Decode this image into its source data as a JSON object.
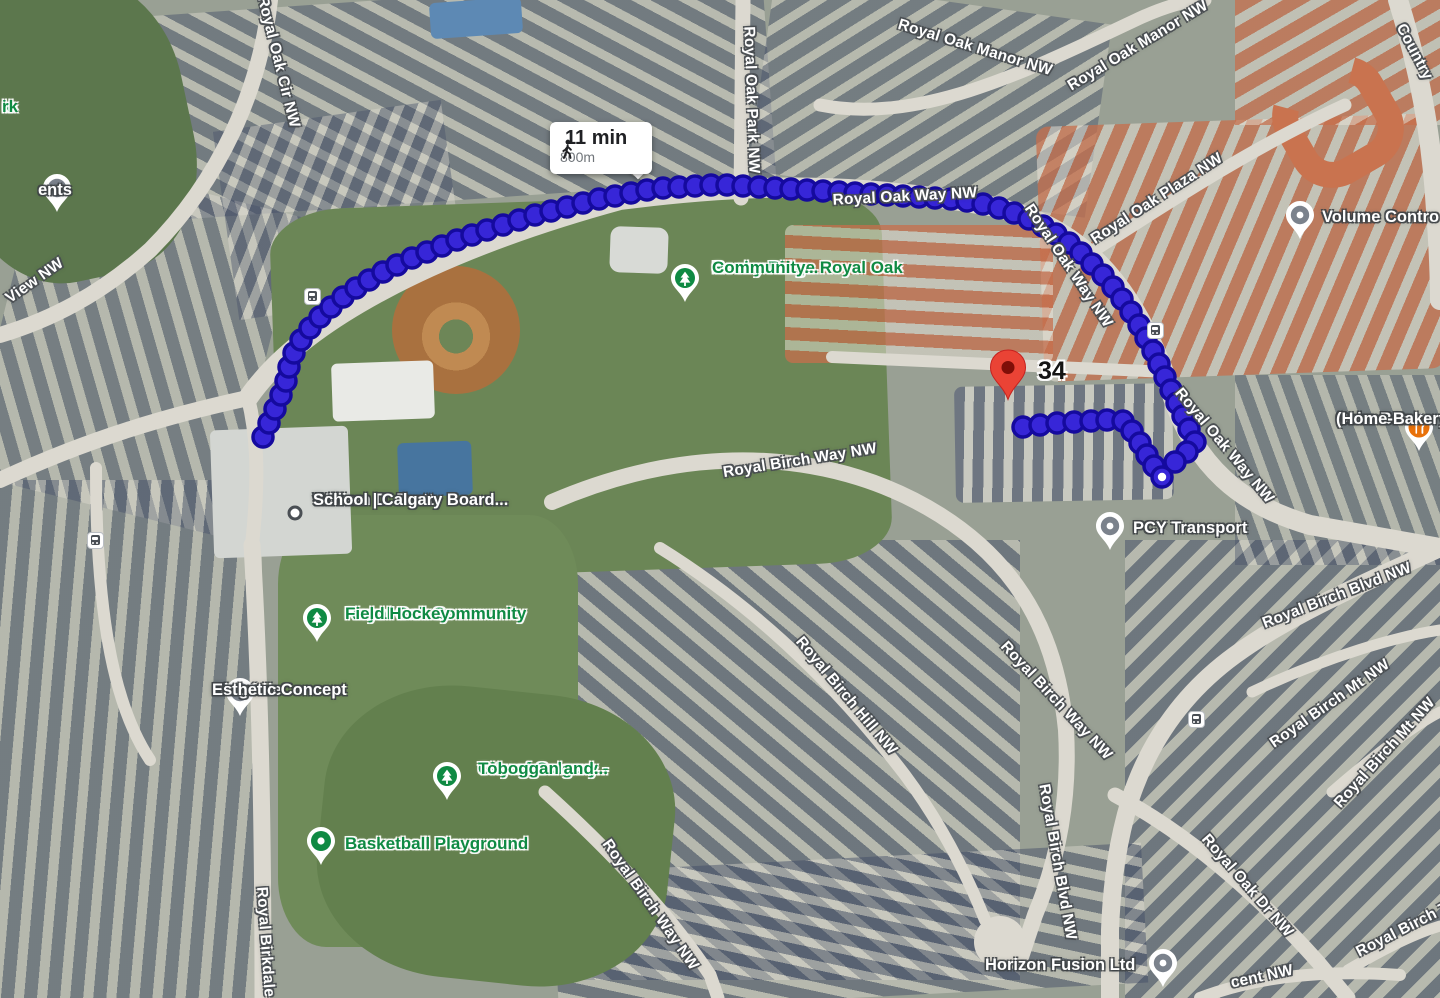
{
  "route": {
    "duration": "11 min",
    "distance": "800m",
    "dot_fill": "#3726d8",
    "dot_stroke": "#150a9e",
    "main_points": [
      [
        263,
        437
      ],
      [
        269,
        423
      ],
      [
        275,
        409
      ],
      [
        281,
        395
      ],
      [
        286,
        381
      ],
      [
        289,
        367
      ],
      [
        294,
        353
      ],
      [
        301,
        340
      ],
      [
        310,
        328
      ],
      [
        320,
        317
      ],
      [
        331,
        307
      ],
      [
        343,
        297
      ],
      [
        356,
        288
      ],
      [
        369,
        280
      ],
      [
        383,
        272
      ],
      [
        397,
        265
      ],
      [
        412,
        258
      ],
      [
        427,
        252
      ],
      [
        442,
        246
      ],
      [
        457,
        240
      ],
      [
        472,
        235
      ],
      [
        487,
        230
      ],
      [
        503,
        225
      ],
      [
        519,
        220
      ],
      [
        535,
        215
      ],
      [
        551,
        211
      ],
      [
        567,
        207
      ],
      [
        583,
        203
      ],
      [
        599,
        199
      ],
      [
        615,
        196
      ],
      [
        631,
        193
      ],
      [
        647,
        190
      ],
      [
        663,
        188
      ],
      [
        679,
        187
      ],
      [
        695,
        186
      ],
      [
        711,
        185
      ],
      [
        727,
        185
      ],
      [
        743,
        186
      ],
      [
        759,
        187
      ],
      [
        775,
        188
      ],
      [
        791,
        189
      ],
      [
        807,
        190
      ],
      [
        823,
        191
      ],
      [
        839,
        192
      ],
      [
        855,
        193
      ],
      [
        871,
        194
      ],
      [
        887,
        195
      ],
      [
        903,
        196
      ],
      [
        919,
        197
      ],
      [
        935,
        198
      ],
      [
        951,
        199
      ],
      [
        967,
        201
      ],
      [
        983,
        204
      ],
      [
        999,
        208
      ],
      [
        1014,
        213
      ],
      [
        1029,
        219
      ],
      [
        1043,
        226
      ],
      [
        1056,
        234
      ],
      [
        1069,
        243
      ],
      [
        1081,
        253
      ],
      [
        1092,
        264
      ],
      [
        1103,
        275
      ],
      [
        1113,
        287
      ],
      [
        1122,
        299
      ],
      [
        1131,
        312
      ],
      [
        1139,
        325
      ],
      [
        1146,
        338
      ],
      [
        1153,
        351
      ],
      [
        1159,
        364
      ],
      [
        1165,
        377
      ],
      [
        1171,
        390
      ],
      [
        1177,
        403
      ],
      [
        1183,
        416
      ],
      [
        1189,
        429
      ],
      [
        1195,
        442
      ],
      [
        1187,
        452
      ],
      [
        1175,
        462
      ]
    ],
    "spur_points": [
      [
        1023,
        427
      ],
      [
        1040,
        425
      ],
      [
        1057,
        423
      ],
      [
        1074,
        422
      ],
      [
        1091,
        421
      ],
      [
        1107,
        420
      ],
      [
        1123,
        421
      ],
      [
        1132,
        431
      ],
      [
        1140,
        443
      ],
      [
        1147,
        455
      ],
      [
        1154,
        466
      ]
    ],
    "terminus": [
      1162,
      477
    ]
  },
  "destination": {
    "label": "34",
    "label_x": 1038,
    "label_y": 373
  },
  "street_labels": [
    {
      "text": "Royal Oak Cir NW",
      "x": 278,
      "y": 62,
      "rot": 76
    },
    {
      "text": "Royal Oak Park NW",
      "x": 751,
      "y": 100,
      "rot": 88
    },
    {
      "text": "Royal Oak Manor NW",
      "x": 975,
      "y": 48,
      "rot": 17
    },
    {
      "text": "Royal Oak Manor NW",
      "x": 1138,
      "y": 46,
      "rot": -31
    },
    {
      "text": "Country",
      "x": 1414,
      "y": 52,
      "rot": 62
    },
    {
      "text": "Royal Oak Way NW",
      "x": 905,
      "y": 197,
      "rot": -3
    },
    {
      "text": "Royal Oak Way NW",
      "x": 1068,
      "y": 266,
      "rot": 56
    },
    {
      "text": "Royal Oak Plaza NW",
      "x": 1157,
      "y": 199,
      "rot": -33
    },
    {
      "text": "Royal Oak Way NW",
      "x": 1224,
      "y": 446,
      "rot": 50
    },
    {
      "text": "Royal Birch Way NW",
      "x": 800,
      "y": 461,
      "rot": -9
    },
    {
      "text": "Royal Birch Hill NW",
      "x": 846,
      "y": 696,
      "rot": 50
    },
    {
      "text": "Royal Birch Way NW",
      "x": 1056,
      "y": 701,
      "rot": 47
    },
    {
      "text": "Royal Birch Blvd NW",
      "x": 1337,
      "y": 596,
      "rot": -21
    },
    {
      "text": "Royal Birch Mt NW",
      "x": 1330,
      "y": 704,
      "rot": -35
    },
    {
      "text": "Royal Birch Mt NW",
      "x": 1385,
      "y": 753,
      "rot": -48
    },
    {
      "text": "Royal Birch Blvd NW",
      "x": 1057,
      "y": 862,
      "rot": 80
    },
    {
      "text": "Royal Birch Way NW",
      "x": 650,
      "y": 905,
      "rot": 55
    },
    {
      "text": "Royal Oak Dr NW",
      "x": 1247,
      "y": 886,
      "rot": 49
    },
    {
      "text": "Royal Birch T",
      "x": 1403,
      "y": 930,
      "rot": -27
    },
    {
      "text": "cent NW",
      "x": 1262,
      "y": 977,
      "rot": -12
    },
    {
      "text": "View NW",
      "x": 35,
      "y": 281,
      "rot": -35
    },
    {
      "text": "Royal Birkdale",
      "x": 265,
      "y": 942,
      "rot": 86
    }
  ],
  "poi_labels": [
    {
      "lines": [
        "ents"
      ],
      "x": 38,
      "y": 190,
      "align": "right",
      "color": "white"
    },
    {
      "lines": [
        "k",
        "rk"
      ],
      "x": 2,
      "y": 107,
      "align": "left",
      "color": "green"
    },
    {
      "lines": [
        "Volume Contro"
      ],
      "x": 1322,
      "y": 217,
      "align": "left",
      "color": "white"
    },
    {
      "lines": [
        "Cake Box",
        "(Home-Bakery)"
      ],
      "x": 1336,
      "y": 419,
      "align": "center",
      "color": "white"
    },
    {
      "lines": [
        "PCY Transport"
      ],
      "x": 1133,
      "y": 528,
      "align": "left",
      "color": "white"
    },
    {
      "lines": [
        "William D. Pratt",
        "School | Calgary Board..."
      ],
      "x": 313,
      "y": 500,
      "align": "left",
      "color": "white"
    },
    {
      "lines": [
        "Horizon Fusion Ltd"
      ],
      "x": 985,
      "y": 965,
      "align": "left",
      "color": "white"
    },
    {
      "lines": [
        "Biogénie",
        "Esthetic Concept"
      ],
      "x": 212,
      "y": 690,
      "align": "right",
      "color": "white"
    },
    {
      "lines": [
        "Rocky Ridge Royal Oak",
        "Community..."
      ],
      "x": 712,
      "y": 268,
      "align": "left",
      "color": "green"
    },
    {
      "lines": [
        "Royal Oak Community",
        "Field Hockey"
      ],
      "x": 345,
      "y": 614,
      "align": "left",
      "color": "green"
    },
    {
      "lines": [
        "City of Calgary -",
        "Toboggan and..."
      ],
      "x": 478,
      "y": 769,
      "align": "left",
      "color": "green"
    },
    {
      "lines": [
        "Basketball Playground"
      ],
      "x": 345,
      "y": 844,
      "align": "left",
      "color": "green"
    }
  ],
  "pins": [
    {
      "type": "gray",
      "x": 57,
      "y": 188
    },
    {
      "type": "gray",
      "x": 240,
      "y": 692
    },
    {
      "type": "gray",
      "x": 1300,
      "y": 215
    },
    {
      "type": "gray",
      "x": 1110,
      "y": 526
    },
    {
      "type": "gray",
      "x": 1163,
      "y": 963
    },
    {
      "type": "tree",
      "x": 685,
      "y": 278
    },
    {
      "type": "tree",
      "x": 317,
      "y": 618
    },
    {
      "type": "tree",
      "x": 447,
      "y": 776
    },
    {
      "type": "gdot",
      "x": 321,
      "y": 841
    },
    {
      "type": "food",
      "x": 1419,
      "y": 427
    },
    {
      "type": "school",
      "x": 295,
      "y": 513
    },
    {
      "type": "red",
      "x": 1008,
      "y": 367
    }
  ],
  "transit_stops": [
    [
      312,
      296
    ],
    [
      95,
      540
    ],
    [
      1155,
      330
    ],
    [
      1196,
      719
    ]
  ]
}
